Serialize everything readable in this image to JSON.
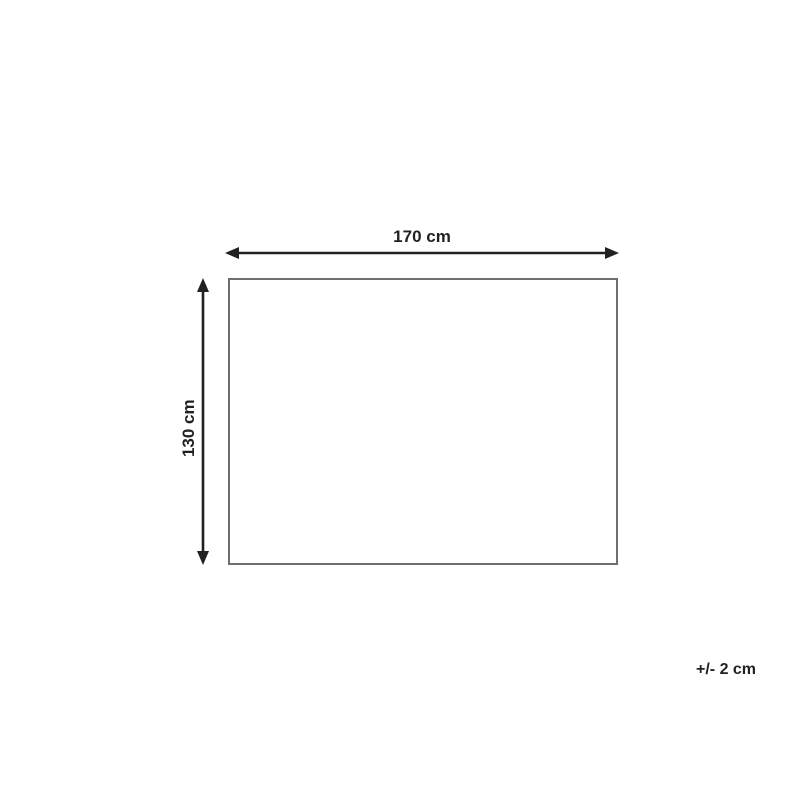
{
  "diagram": {
    "type": "product-dimension-diagram",
    "width_label": "170 cm",
    "height_label": "130 cm",
    "tolerance_label": "+/- 2 cm",
    "colors": {
      "ink": "#232020",
      "rectangle_border": "#6d6e71",
      "background": "#ffffff"
    }
  }
}
